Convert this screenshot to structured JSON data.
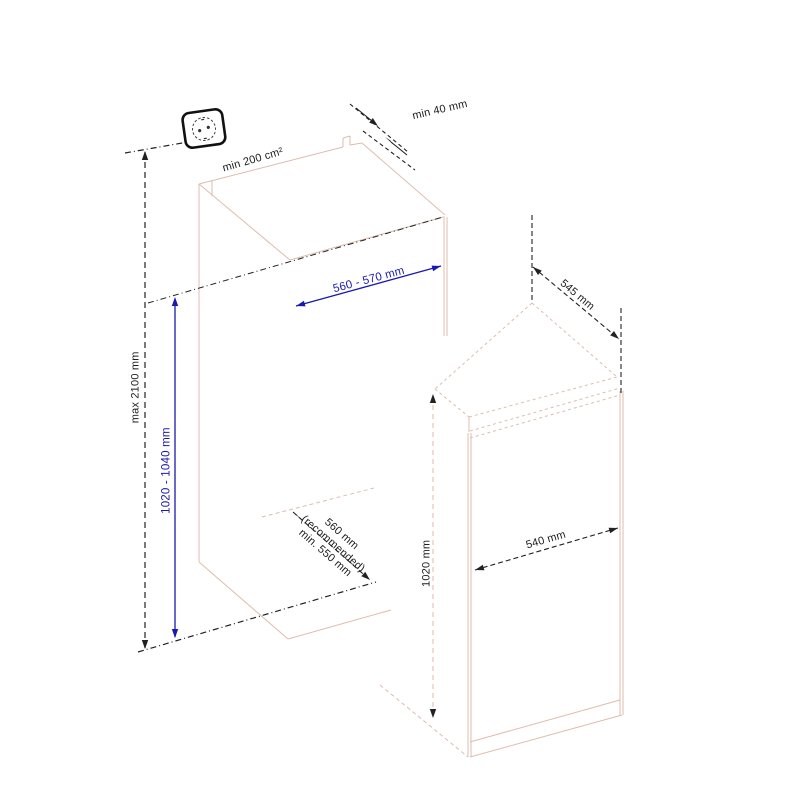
{
  "diagram": {
    "type": "built-in appliance installation dimensions",
    "labels": {
      "socket_max_height": "max 2100 mm",
      "vent_area": "min 200 cm²",
      "top_clearance": "min 40 mm",
      "niche_width": "560 - 570 mm",
      "niche_height": "1020 - 1040 mm",
      "niche_depth": {
        "line1": "560 mm",
        "line2": "(recommended)",
        "line3": "min. 550 mm"
      },
      "appliance_depth": "545 mm",
      "appliance_width": "540 mm",
      "appliance_height": "1020 mm"
    },
    "colors": {
      "dimension_blue": "#1a1aae",
      "outline_pink": "#ddbdae",
      "line_black": "#222222"
    }
  }
}
